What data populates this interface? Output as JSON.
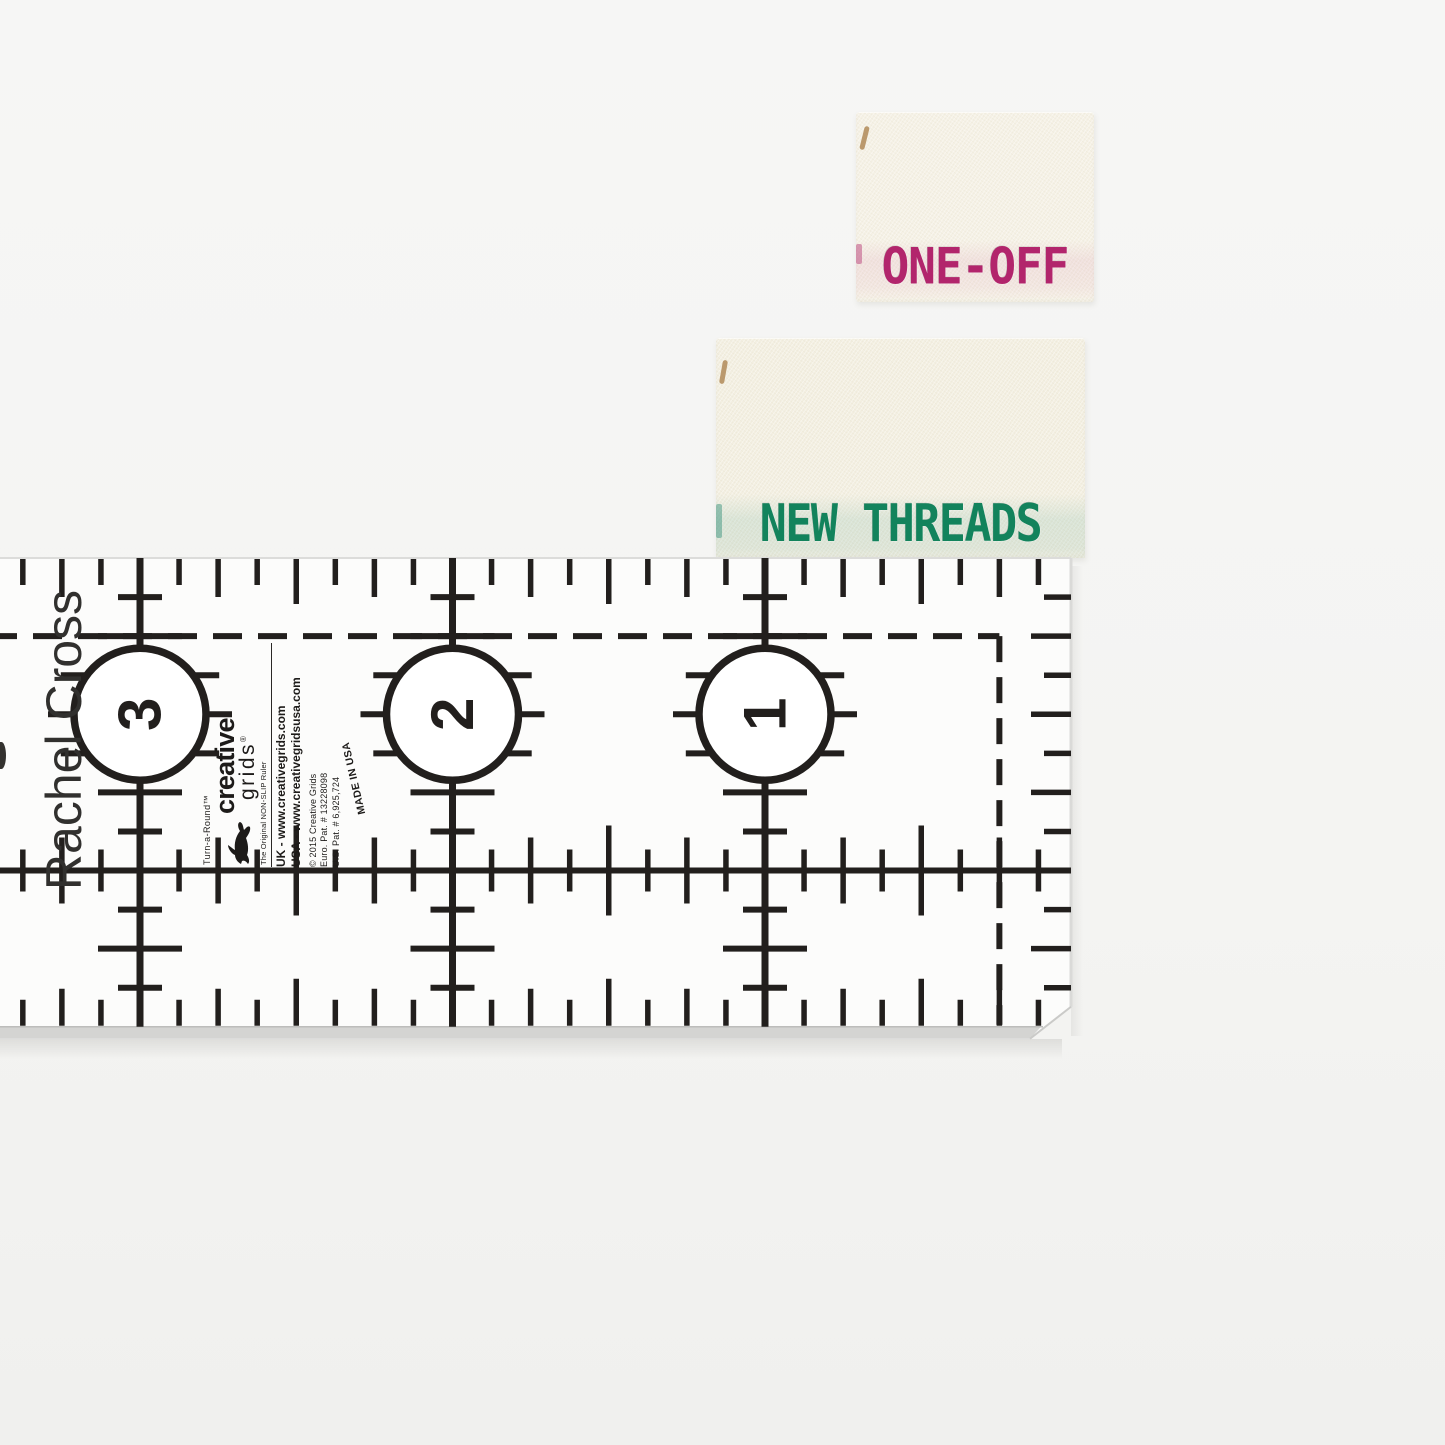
{
  "photo": {
    "background_top": "#f6f6f5",
    "background_bottom": "#f0f0ee"
  },
  "woven_labels": {
    "one_off": {
      "text": "ONE-OFF",
      "text_color": "#b2256c",
      "fabric_color": "#f5f1e5",
      "accent_stripe": "#d687ab"
    },
    "new_threads": {
      "text": "NEW THREADS",
      "text_color": "#12835c",
      "fabric_color": "#f3efe1",
      "accent_stripe": "#5aa896"
    }
  },
  "ruler": {
    "ink_color": "#221f1d",
    "surface_color": "#fcfcfb",
    "owner_name": "Rachel Cross",
    "inch_numbers": [
      "3",
      "2",
      "1"
    ],
    "brand": {
      "product": "Turn-a-Round™",
      "name_primary": "creative",
      "name_secondary": "grids",
      "registered": "®",
      "tagline": "The Original NON-SLIP Ruler",
      "uk_line": "UK - www.creativegrids.com",
      "usa_line": "USA - www.creativegridsusa.com",
      "copyright_line": "© 2015 Creative Grids",
      "euro_patent": "Euro. Pat. # 13228098",
      "us_patent": "U.S. Pat. # 6,925,724",
      "made_in": "MADE IN USA"
    },
    "geometry": {
      "left": -12,
      "top": 558,
      "right": 1071,
      "unit_px": 312.5,
      "origin_x": 140,
      "circle_radius": 66
    }
  }
}
